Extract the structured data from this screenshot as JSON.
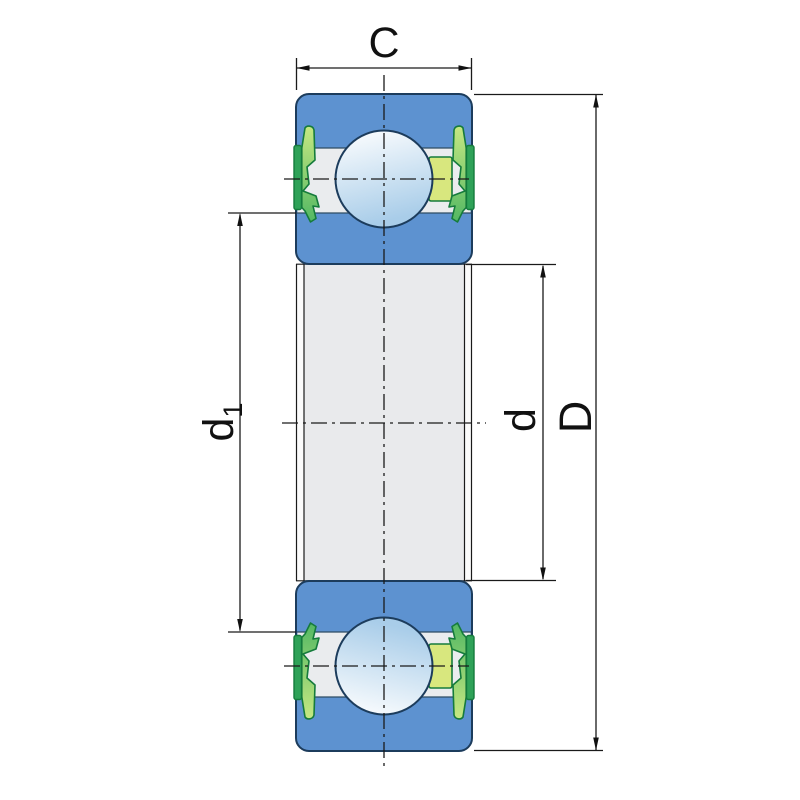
{
  "diagram": {
    "name": "deep-groove-ball-bearing-cross-section",
    "dimension_labels": {
      "width_top": "C",
      "outer_diameter": "D",
      "bore_diameter": "d",
      "recess_diameter_main": "d",
      "recess_diameter_sub": "1"
    },
    "colors": {
      "ring_blue": "#5d92d0",
      "outline_navy": "#1c3c5c",
      "raceway_gray": "#eaecee",
      "raceway_edge": "#2e4b63",
      "bore_gray": "#e9eaec",
      "bore_edge_white": "#fbfbfb",
      "seal_strip_green": "#2fa258",
      "seal_body_light": "#c6e882",
      "seal_body_dark": "#53b863",
      "seal_outline": "#157b3c",
      "cage_yellow": "#d8e77e",
      "ball_light": "#ffffff",
      "ball_shade": "#a9cde9",
      "line_black": "#1a1a1a"
    }
  }
}
